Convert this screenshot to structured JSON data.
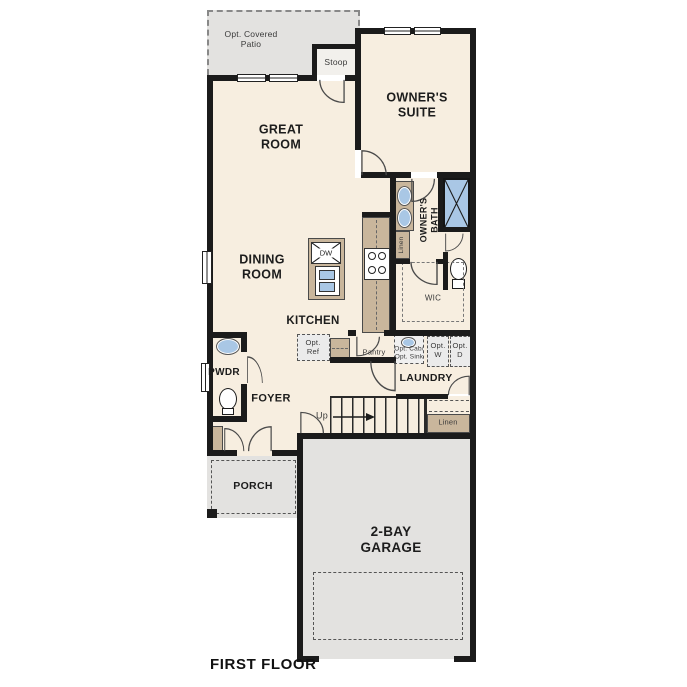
{
  "plan": {
    "title": "FIRST FLOOR",
    "labels": {
      "patio": "Opt. Covered\nPatio",
      "stoop": "Stoop",
      "owners_suite": "OWNER'S\nSUITE",
      "great_room": "GREAT\nROOM",
      "dining_room": "DINING\nROOM",
      "kitchen": "KITCHEN",
      "owners_bath": "OWNER'S\nBATH",
      "linen_bath": "Linen",
      "wic": "WIC",
      "dw": "DW",
      "opt_ref": "Opt.\nRef",
      "pantry": "Pantry",
      "opt_cab_sink": "Opt. Cab/\nOpt. Sink",
      "opt_washer": "Opt.\nW",
      "opt_dryer": "Opt.\nD",
      "laundry": "LAUNDRY",
      "pwdr": "PWDR",
      "foyer": "FOYER",
      "up": "Up",
      "linen_hall": "Linen",
      "porch": "PORCH",
      "garage": "2-BAY\nGARAGE"
    },
    "colors": {
      "background": "#ffffff",
      "floor": "#f7eee0",
      "outdoor": "#e3e2e0",
      "counter": "#c9b69c",
      "fixture_blue": "#a9c7e5",
      "wall": "#1b1b1b"
    }
  }
}
